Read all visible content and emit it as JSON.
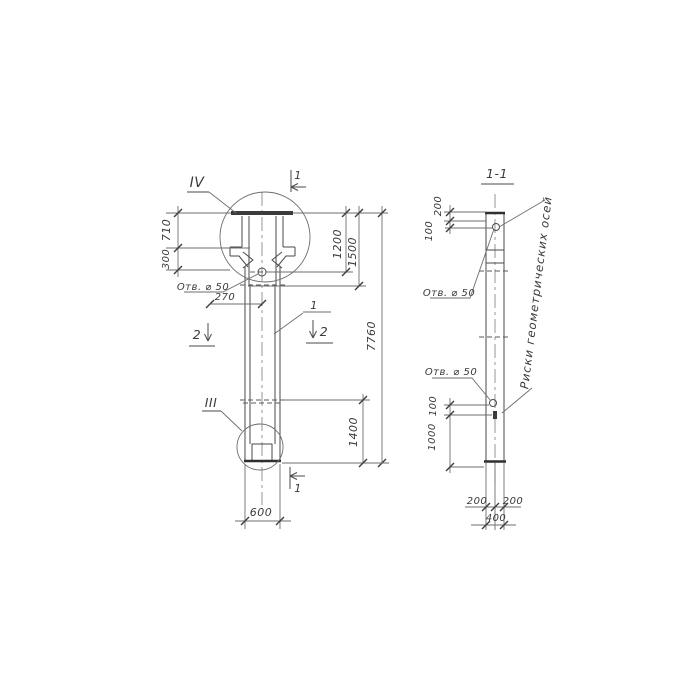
{
  "labels": {
    "detail_top": "IV",
    "detail_bottom": "III",
    "section_cut_top": "1",
    "section_cut_bottom": "1",
    "section_cut_left": "2",
    "section_cut_right": "2",
    "position": "1"
  },
  "main_view": {
    "hole_label": "Отв. ⌀ 50",
    "dims": {
      "left_upper": "710",
      "left_lower": "300",
      "hole_offset": "270",
      "right_inner": "1200",
      "right_mid": "1500",
      "right_total": "7760",
      "right_bottom": "1400",
      "bottom_width": "600"
    }
  },
  "section_view": {
    "title": "1-1",
    "hole_label_top": "Отв. ⌀ 50",
    "hole_label_bottom": "Отв. ⌀ 50",
    "note": "Риски геометрических осей",
    "dims": {
      "top_upper": "200",
      "top_lower": "100",
      "bottom_upper": "100",
      "bottom_lower": "1000",
      "width_left": "200",
      "width_right": "200",
      "width_total": "400"
    }
  }
}
